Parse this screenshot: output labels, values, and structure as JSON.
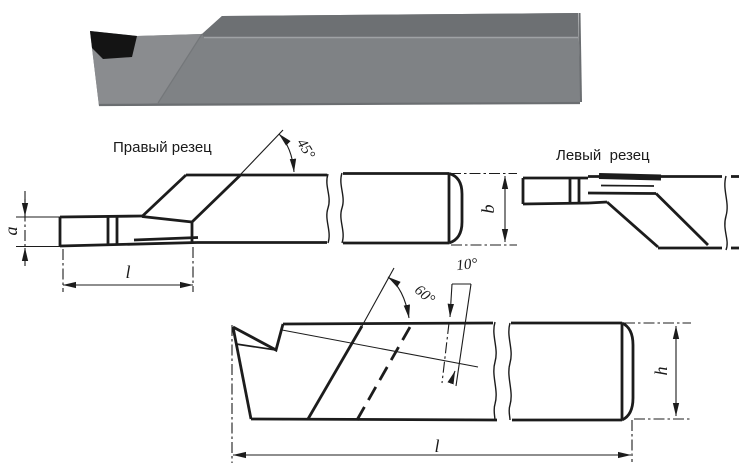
{
  "page": {
    "background": "#ffffff"
  },
  "photo": {
    "description": "3d-render-of-turning-tool",
    "colors": {
      "body": "#7f8285",
      "top_face": "#6d7073",
      "tip_face": "#8a8c8f",
      "insert": "#141414",
      "edge": "#6b6e71"
    }
  },
  "drawing": {
    "line_color": "#1c1c1c",
    "labels": {
      "right_cutter": "Правый резец",
      "left_cutter": "Левый  резец",
      "angle_45": "45°",
      "angle_60": "60°",
      "angle_10": "10°",
      "dim_a": "a",
      "dim_b": "b",
      "dim_h": "h",
      "dim_l_front": "l",
      "dim_l_total": "l"
    }
  }
}
